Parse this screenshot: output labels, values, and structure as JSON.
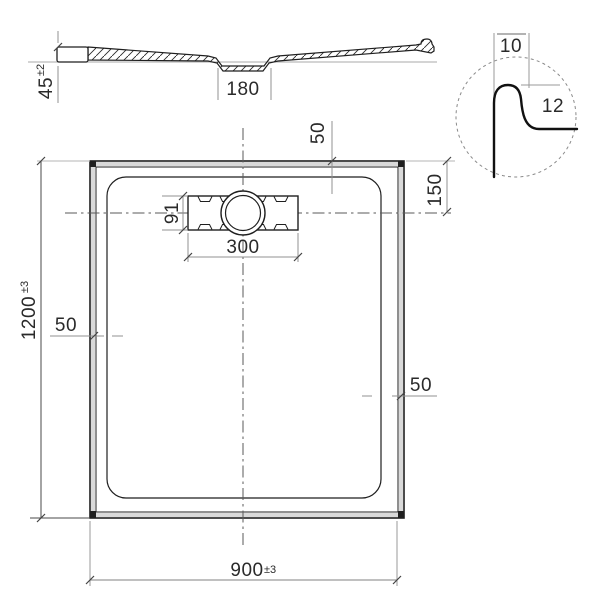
{
  "document": {
    "type": "technical dimension drawing",
    "subject": "rectangular shower tray with drain"
  },
  "section_view": {
    "height": "45",
    "height_tolerance": "±2",
    "drain_recess_width": "180"
  },
  "detail_view": {
    "top_width": "10",
    "profile_height": "12"
  },
  "plan_view": {
    "length": "1200",
    "length_tolerance": "±3",
    "width": "900",
    "width_tolerance": "±3",
    "drain_width": "300",
    "drain_height": "91",
    "top_offset": "50",
    "right_center_offset": "150",
    "left_offset": "50",
    "right_offset": "50"
  },
  "colors": {
    "line": "#1f1f1f",
    "dimension_line": "#909090",
    "extension_line": "#b5b5b5",
    "centerline": "#5a5a5a",
    "text": "#2a2a2a",
    "wall_fill": "#d9d9d9",
    "background": "#ffffff"
  }
}
